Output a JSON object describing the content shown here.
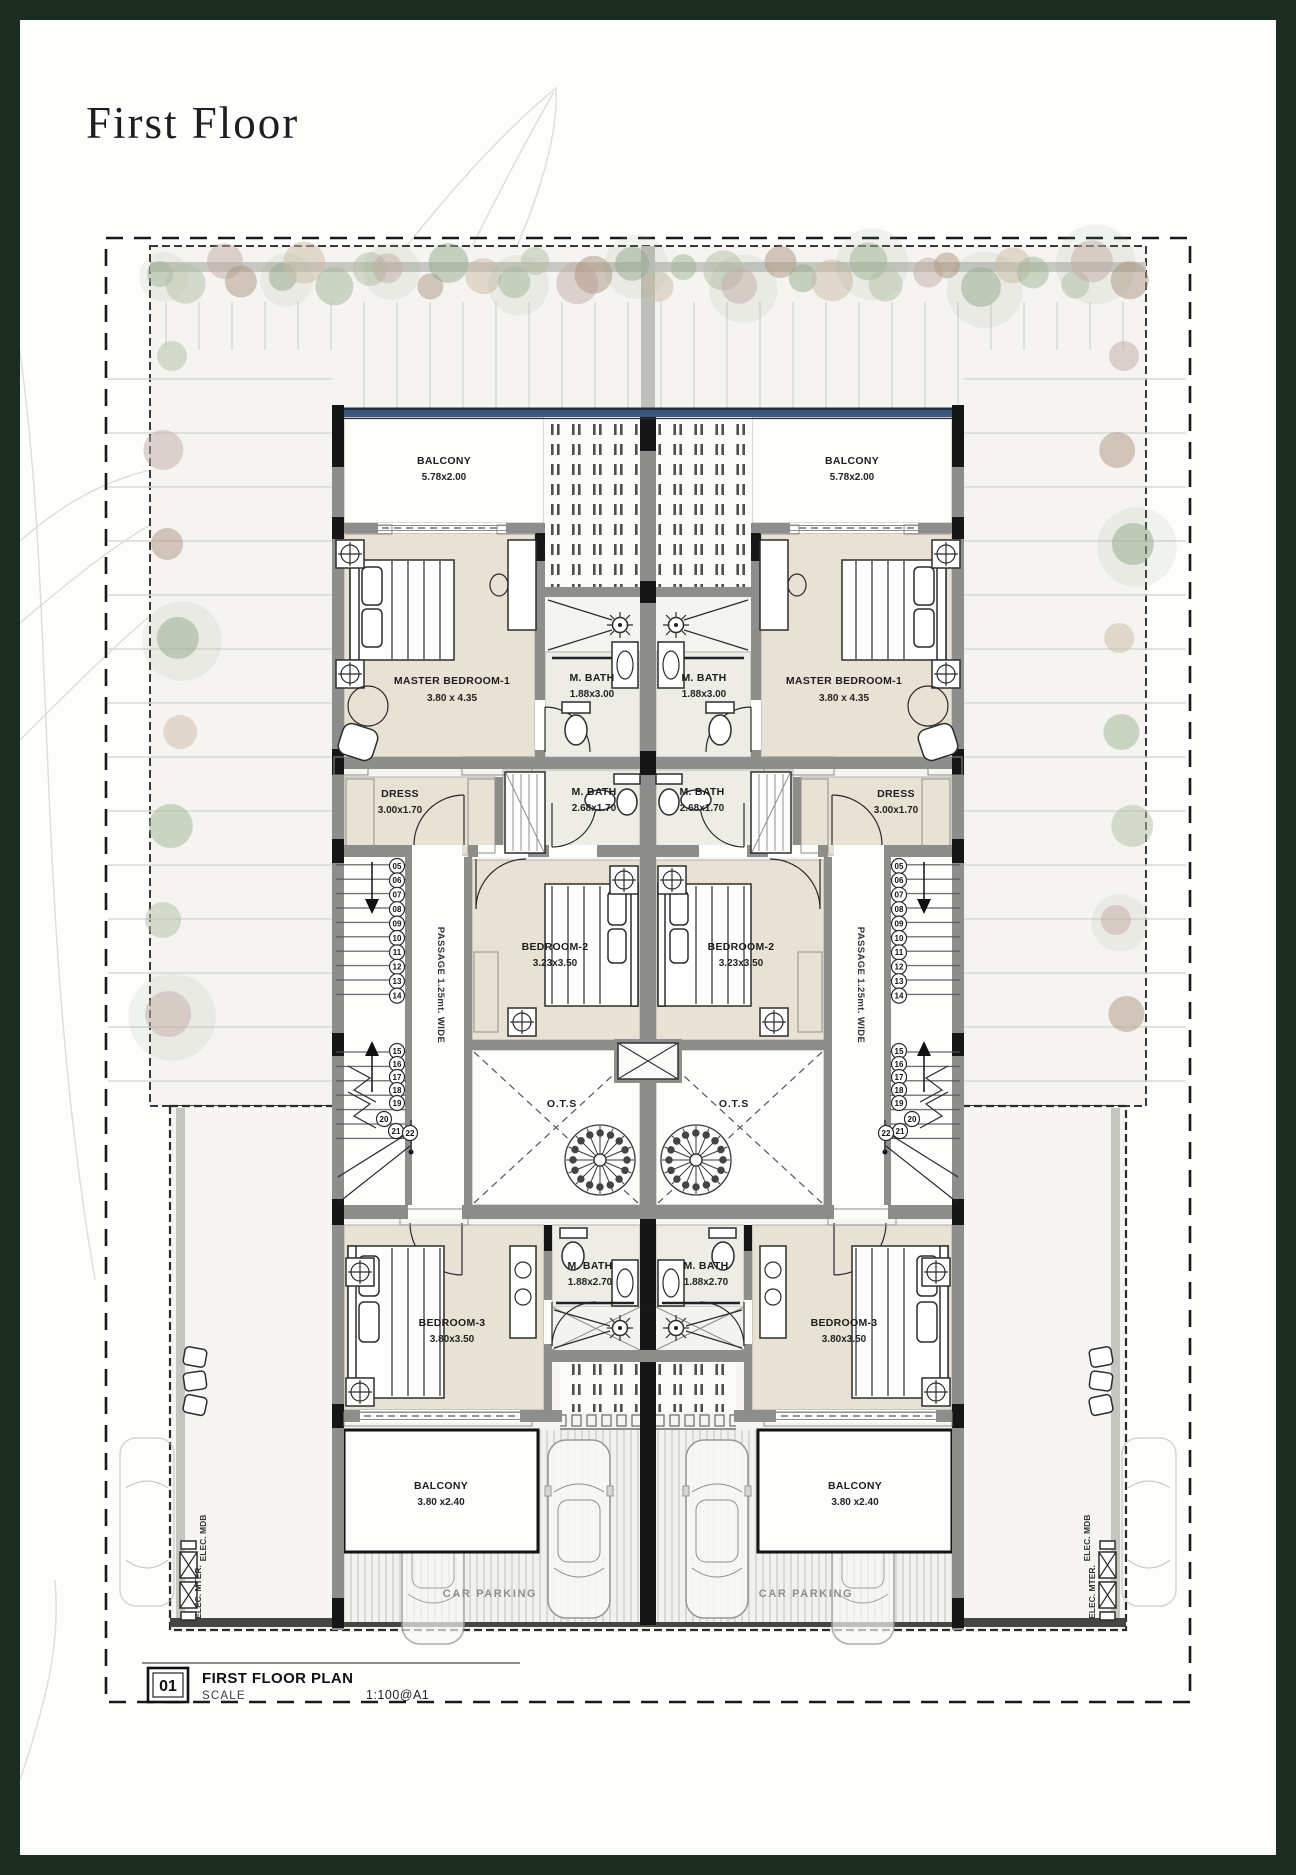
{
  "page": {
    "title": "First Floor"
  },
  "plan": {
    "balcony_top": {
      "name": "BALCONY",
      "dim": "5.78x2.00"
    },
    "master_bedroom": {
      "name": "MASTER BEDROOM-1",
      "dim": "3.80 x 4.35"
    },
    "m_bath_top": {
      "name": "M. BATH",
      "dim": "1.88x3.00"
    },
    "dress": {
      "name": "DRESS",
      "dim": "3.00x1.70"
    },
    "m_bath_mid": {
      "name": "M. BATH",
      "dim": "2.68x1.70"
    },
    "bedroom_2": {
      "name": "BEDROOM-2",
      "dim": "3.23x3.50"
    },
    "ots": {
      "name": "O.T.S"
    },
    "passage": {
      "label": "PASSAGE 1.25mt. WIDE"
    },
    "bedroom_3": {
      "name": "BEDROOM-3",
      "dim": "3.80x3.50"
    },
    "m_bath_bottom": {
      "name": "M. BATH",
      "dim": "1.88x2.70"
    },
    "balcony_bottom": {
      "name": "BALCONY",
      "dim": "3.80 x2.40"
    },
    "car_parking": "CAR PARKING",
    "elec_meter": "ELEC. MTER.",
    "elec_mdb": "ELEC. MDB"
  },
  "stairs": {
    "upper": [
      "05",
      "06",
      "07",
      "08",
      "09",
      "10",
      "11",
      "12",
      "13",
      "14"
    ],
    "lower": [
      "15",
      "16",
      "17",
      "18",
      "19",
      "20",
      "21",
      "22"
    ]
  },
  "title_block": {
    "number": "01",
    "name": "FIRST FLOOR PLAN",
    "scale_label": "SCALE",
    "scale_value": "1:100@A1"
  },
  "colors": {
    "frame_green": "#1b2c21",
    "glass_blue": "#39577f",
    "floor_beige": "#e8e2d5",
    "wall_gray": "#8d8d8c"
  }
}
